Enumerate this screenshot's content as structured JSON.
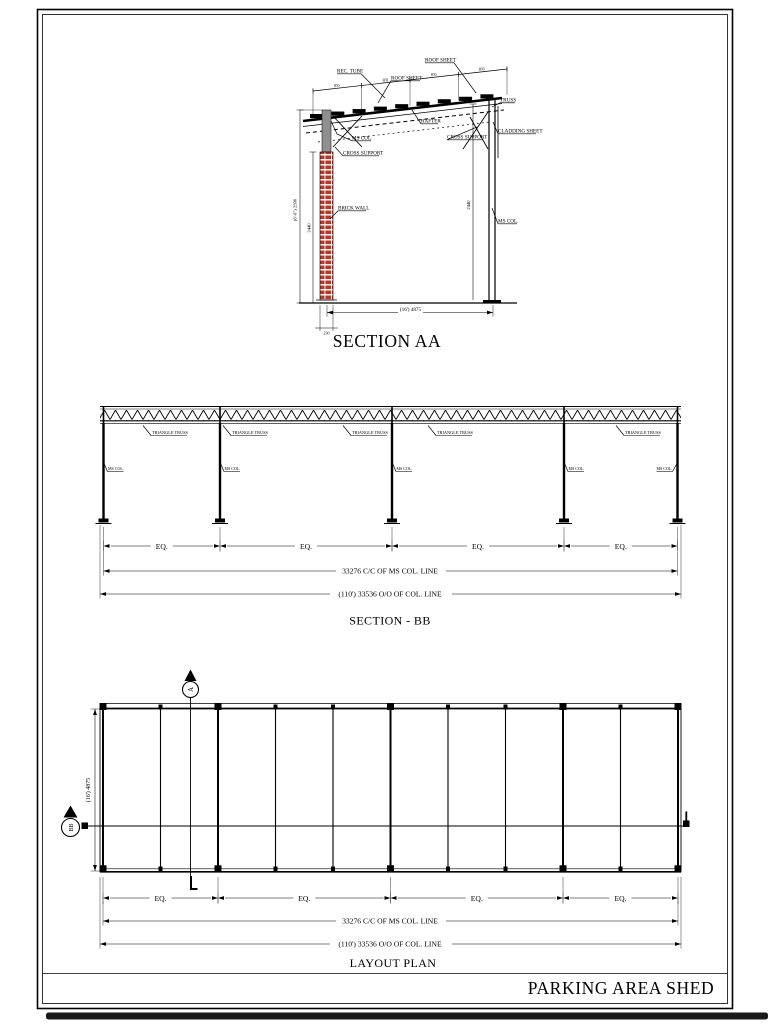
{
  "title_block": {
    "project_title": "PARKING AREA SHED"
  },
  "section_aa": {
    "title": "SECTION AA",
    "roof_segment_dim": "8'0",
    "labels": {
      "rec_tube": "REC. TUBE",
      "roof_sheet1": "ROOF SHEET",
      "roof_sheet2": "ROOF SHEET",
      "truss": "TRUSS",
      "cladding_sheet": "CLADDING SHEET",
      "rafter": "RAFTER",
      "cross_support_left": "CROSS SUPPORT",
      "cross_support_right": "CROSS SUPPORT",
      "ms_col_left": "MS COL.",
      "ms_col_right": "MS COL.",
      "brick_wall": "BRICK WALL"
    },
    "dims": {
      "width": "(16') 4875",
      "height_left_outer": "(8'-6\") 2590",
      "height_left_inner": "2440",
      "height_right": "2440",
      "wall_thickness": "230"
    }
  },
  "section_bb": {
    "title": "SECTION - BB",
    "truss_label": "TRIANGLE TRUSS",
    "column_label": "MS COL.",
    "dims": {
      "eq": "EQ.",
      "cc": "33276 C/C OF MS COL. LINE",
      "oo": "(110') 33536 O/O OF COL. LINE"
    }
  },
  "layout_plan": {
    "title": "LAYOUT PLAN",
    "section_marker_top": "A",
    "section_marker_left": "BB",
    "dims": {
      "eq": "EQ.",
      "cc": "33276 C/C OF MS COL. LINE",
      "oo": "(110') 33536 O/O OF COL. LINE",
      "depth": "(16') 4875"
    }
  },
  "colors": {
    "ink": "#000000",
    "brick": "#b03a2e",
    "steel": "#8f8f8f"
  }
}
